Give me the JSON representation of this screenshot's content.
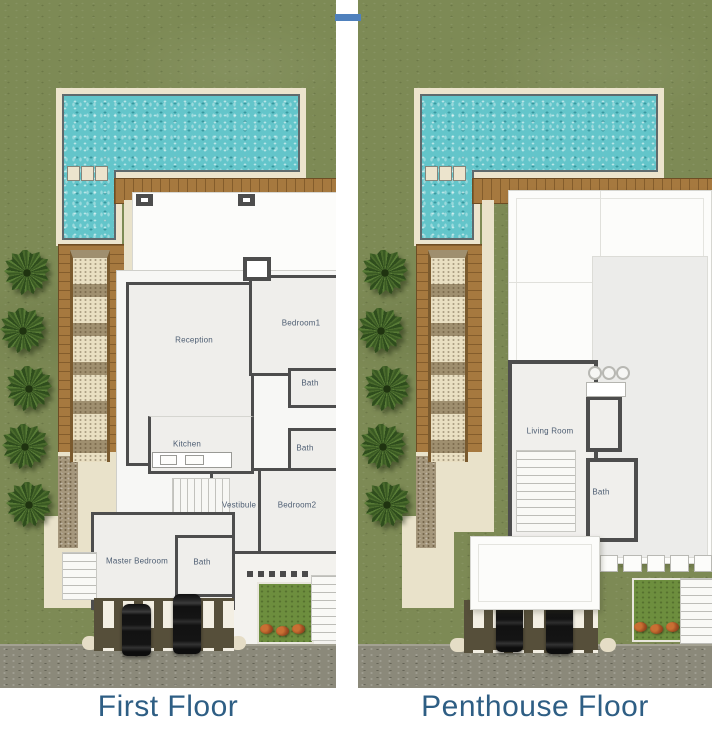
{
  "panels": [
    {
      "title": "First Floor",
      "rooms": [
        {
          "label": "Reception",
          "x": 194,
          "y": 340
        },
        {
          "label": "Bedroom1",
          "x": 301,
          "y": 323
        },
        {
          "label": "Bath",
          "x": 310,
          "y": 383
        },
        {
          "label": "Bath",
          "x": 305,
          "y": 448
        },
        {
          "label": "Kitchen",
          "x": 187,
          "y": 444
        },
        {
          "label": "Vestibule",
          "x": 239,
          "y": 505
        },
        {
          "label": "Bedroom2",
          "x": 297,
          "y": 505
        },
        {
          "label": "Master Bedroom",
          "x": 137,
          "y": 561
        },
        {
          "label": "Bath",
          "x": 202,
          "y": 562
        }
      ]
    },
    {
      "title": "Penthouse Floor",
      "rooms": [
        {
          "label": "Living Room",
          "x": 192,
          "y": 431
        },
        {
          "label": "Bath",
          "x": 243,
          "y": 492
        }
      ]
    }
  ],
  "icons": {
    "palm-tree": "top-view palm canopy",
    "car": "top-view parked car",
    "shrub": "orange flowering bush"
  },
  "colors": {
    "grass": "#7d8a55",
    "water": "#63c5ca",
    "pool-cream": "#ece4cd",
    "wood": "#a6793f",
    "wall": "#4d4d4d",
    "terrace-gray": "#ececea",
    "pergola": "#564f3a",
    "road": "#8b897a",
    "garden": "#6d8e3e",
    "shrub": "#a04e22",
    "pave": "#e9dfc2",
    "label": "#4d5d72",
    "title": "#2e5e84",
    "divider": "#4f81bd"
  }
}
